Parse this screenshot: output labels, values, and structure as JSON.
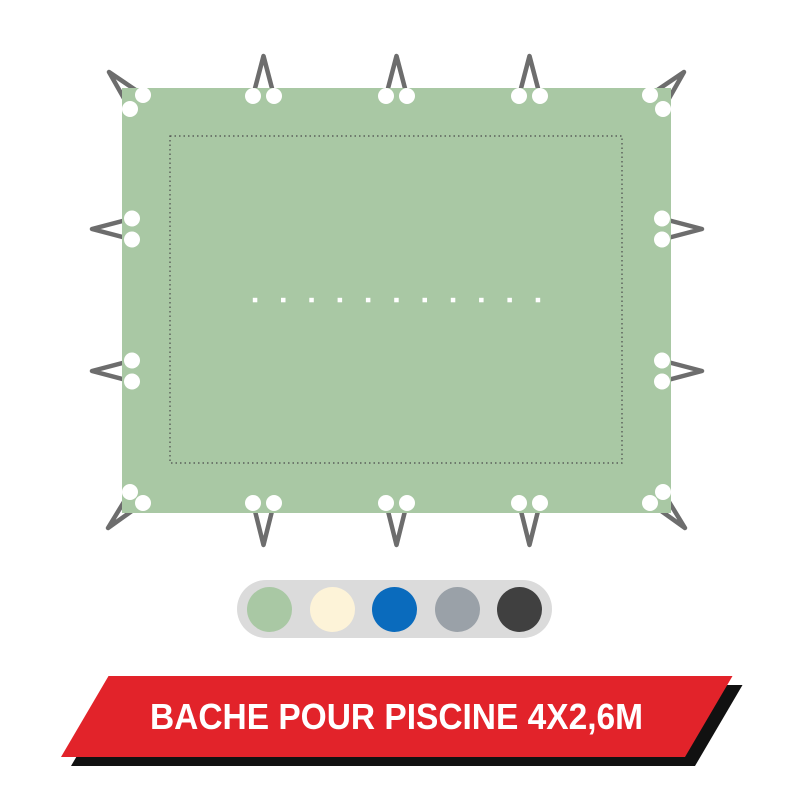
{
  "product": {
    "banner_label": "BACHE POUR PISCINE 4X2,6M"
  },
  "colors": {
    "tarp_green": "#a9c8a4",
    "cord_gray": "#6d6d6d",
    "eyelet_white": "#ffffff",
    "stitch_gray": "#4a4a4a",
    "perforation_white": "#ffffff",
    "swatch_pill_bg": "#dbdbdb",
    "banner_red": "#e2232a",
    "banner_shadow": "#111111",
    "banner_text": "#ffffff"
  },
  "swatches": {
    "options": [
      {
        "name": "green",
        "color": "#a9c8a4"
      },
      {
        "name": "cream",
        "color": "#fdf3d8"
      },
      {
        "name": "blue",
        "color": "#0a6bbd"
      },
      {
        "name": "gray",
        "color": "#9aa1a8"
      },
      {
        "name": "anthracite",
        "color": "#404040"
      }
    ]
  }
}
